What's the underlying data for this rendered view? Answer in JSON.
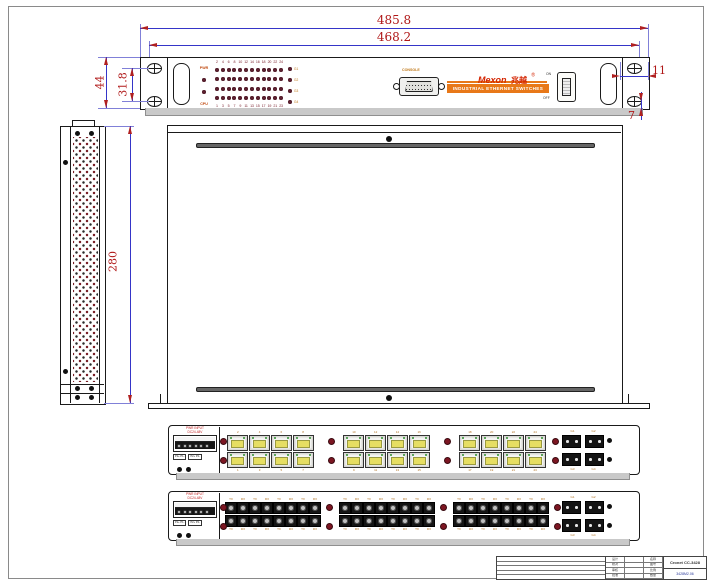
{
  "dims": {
    "overall_width": "485.8",
    "mounting_width": "468.2",
    "panel_height": "44",
    "hole_spacing": "31.8",
    "bracket_width": "11",
    "bracket_drop": "7",
    "chassis_depth": "280"
  },
  "front_panel": {
    "led_pwr": "PWR",
    "led_cpu": "CPU",
    "numbers_top": [
      "2",
      "4",
      "6",
      "8",
      "10",
      "12",
      "14",
      "16",
      "18",
      "20",
      "22",
      "24"
    ],
    "numbers_bottom": [
      "1",
      "3",
      "5",
      "7",
      "9",
      "11",
      "13",
      "15",
      "17",
      "19",
      "21",
      "23"
    ],
    "gig_labels": [
      "G1",
      "G2",
      "G3",
      "G4"
    ],
    "console_label": "CONSOLE",
    "brand": "Mexon",
    "brand_cn": "兆越",
    "reg_mark": "®",
    "banner": "INDUSTRIAL ETHERNET SWITCHES",
    "switch_on": "ON",
    "switch_off": "OFF"
  },
  "rear": {
    "power_line1": "PWR INPUT",
    "power_line2": "DC24-48V",
    "label_box1": "P1+ P1-",
    "label_box2": "P2+ P2-",
    "fiber_tx": "TX",
    "fiber_rx": "RX"
  },
  "title_block": {
    "model": "Cronet CC-3428",
    "drawing_no": "3428M2.06",
    "cells": [
      "设计",
      "",
      "名称",
      "校对",
      "",
      "图号",
      "审核",
      "",
      "比例",
      "批准",
      "",
      "数量"
    ]
  },
  "colors": {
    "dim_line": "#3535c8",
    "dim_text": "#b01818",
    "accent_orange": "#e87818",
    "brand_red": "#d42400",
    "led_maroon": "#5e2030",
    "port_yellow": "#e6de62"
  }
}
